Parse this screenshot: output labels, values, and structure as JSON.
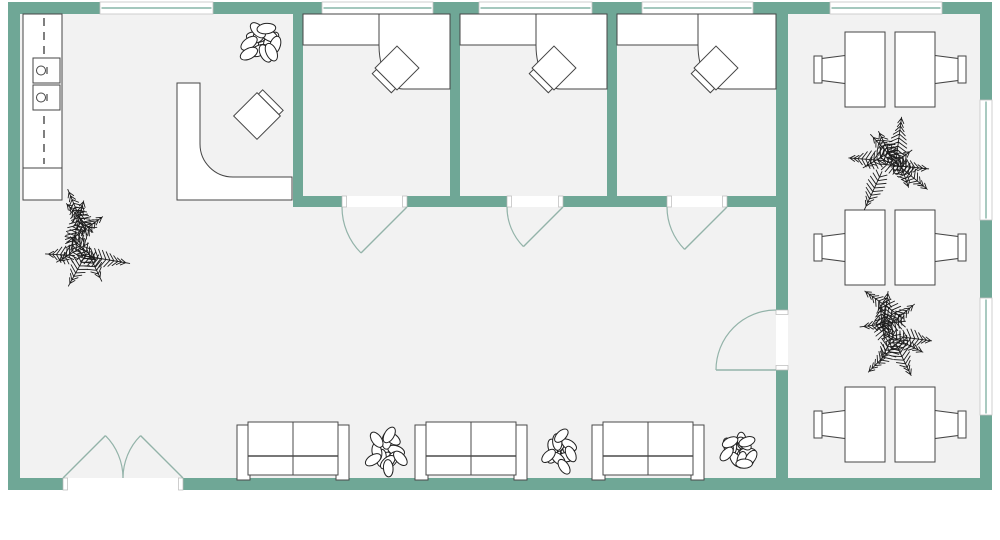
{
  "canvas": {
    "width": 1000,
    "height": 540
  },
  "colors": {
    "background": "#FFFFFF",
    "floor": "#F2F2F2",
    "wall": "#6FA796",
    "window_glass": "#FFFFFF",
    "window_frame": "#C4C4C4",
    "window_mullion": "#6FA796",
    "door": "#93B3A9",
    "jamb": "#B9B9B9",
    "furniture_stroke": "#454545",
    "furniture_fill": "#FFFFFF",
    "sofa_stroke": "#4A4A4A",
    "plant_leaf_stroke": "#222222",
    "plant_palm": "#1C1C1C"
  },
  "building": {
    "x": 8,
    "y": 2,
    "w": 984,
    "h": 488,
    "wall_thickness": 12
  },
  "exterior_walls": [
    {
      "name": "exterior-wall-top",
      "x": 8,
      "y": 2,
      "w": 984,
      "h": 12
    },
    {
      "name": "exterior-wall-bottom",
      "x": 8,
      "y": 478,
      "w": 984,
      "h": 12
    },
    {
      "name": "exterior-wall-left",
      "x": 8,
      "y": 2,
      "w": 12,
      "h": 488
    },
    {
      "name": "exterior-wall-right",
      "x": 980,
      "y": 2,
      "w": 12,
      "h": 488
    }
  ],
  "interior_walls": [
    {
      "name": "office-wall-left",
      "x": 293,
      "y": 14,
      "w": 10,
      "h": 193
    },
    {
      "name": "office-wall-1-2",
      "x": 450,
      "y": 14,
      "w": 10,
      "h": 193
    },
    {
      "name": "office-wall-2-3",
      "x": 607,
      "y": 14,
      "w": 10,
      "h": 193
    },
    {
      "name": "cafe-divider-wall",
      "x": 776,
      "y": 14,
      "w": 12,
      "h": 464
    },
    {
      "name": "office-front-wall",
      "x": 293,
      "y": 196,
      "w": 495,
      "h": 11
    }
  ],
  "windows": [
    {
      "name": "window-top-1",
      "x": 100,
      "y": 2,
      "w": 113,
      "h": 12,
      "orient": "h"
    },
    {
      "name": "window-top-2",
      "x": 322,
      "y": 2,
      "w": 111,
      "h": 12,
      "orient": "h"
    },
    {
      "name": "window-top-3",
      "x": 479,
      "y": 2,
      "w": 113,
      "h": 12,
      "orient": "h"
    },
    {
      "name": "window-top-4",
      "x": 642,
      "y": 2,
      "w": 111,
      "h": 12,
      "orient": "h"
    },
    {
      "name": "window-top-5",
      "x": 830,
      "y": 2,
      "w": 112,
      "h": 12,
      "orient": "h"
    },
    {
      "name": "window-right-1",
      "x": 980,
      "y": 100,
      "w": 12,
      "h": 120,
      "orient": "v"
    },
    {
      "name": "window-right-2",
      "x": 980,
      "y": 298,
      "w": 12,
      "h": 117,
      "orient": "v"
    }
  ],
  "door_openings": [
    {
      "name": "entry-opening",
      "x": 63,
      "y": 478,
      "w": 120,
      "h": 12
    },
    {
      "name": "office-door-opening-1",
      "x": 342,
      "y": 196,
      "w": 65,
      "h": 11
    },
    {
      "name": "office-door-opening-2",
      "x": 507,
      "y": 196,
      "w": 56,
      "h": 11
    },
    {
      "name": "office-door-opening-3",
      "x": 667,
      "y": 196,
      "w": 60,
      "h": 11
    },
    {
      "name": "cafe-door-opening",
      "x": 776,
      "y": 310,
      "w": 12,
      "h": 60
    }
  ],
  "doors": [
    {
      "name": "office-door-1",
      "hinge": [
        407,
        207
      ],
      "tip": [
        361,
        253
      ],
      "arc_from": [
        342,
        207
      ],
      "arc_to": [
        361,
        253
      ],
      "r": 65,
      "sweep": 0
    },
    {
      "name": "office-door-2",
      "hinge": [
        563,
        207
      ],
      "tip": [
        523.4,
        246.6
      ],
      "arc_from": [
        507,
        207
      ],
      "arc_to": [
        523.4,
        246.6
      ],
      "r": 56,
      "sweep": 0
    },
    {
      "name": "office-door-3",
      "hinge": [
        727,
        207
      ],
      "tip": [
        684.6,
        249.4
      ],
      "arc_from": [
        667,
        207
      ],
      "arc_to": [
        684.6,
        249.4
      ],
      "r": 60,
      "sweep": 0
    },
    {
      "name": "cafe-door",
      "hinge": [
        776,
        370
      ],
      "tip": [
        716,
        370
      ],
      "arc_from": [
        776,
        310
      ],
      "arc_to": [
        716,
        370
      ],
      "r": 60,
      "sweep": 0
    },
    {
      "name": "entry-door-left",
      "hinge": [
        63,
        478
      ],
      "tip": [
        105.4,
        435.6
      ],
      "arc_from": [
        105.4,
        435.6
      ],
      "arc_to": [
        123,
        478
      ],
      "r": 60,
      "sweep": 1
    },
    {
      "name": "entry-door-right",
      "hinge": [
        183,
        478
      ],
      "tip": [
        140.6,
        435.6
      ],
      "arc_from": [
        140.6,
        435.6
      ],
      "arc_to": [
        123,
        478
      ],
      "r": 60,
      "sweep": 0
    }
  ],
  "furniture": {
    "kitchen_counter": {
      "x": 23,
      "y": 14,
      "w": 39,
      "main_h": 154,
      "cabinet_h": 32,
      "dash_x": 44,
      "appliances": [
        {
          "x": 33,
          "y": 58,
          "w": 27,
          "h": 25,
          "knob_cx": 41,
          "knob_cy": 70.5,
          "tick_x": 47
        },
        {
          "x": 33,
          "y": 85,
          "w": 27,
          "h": 25,
          "knob_cx": 41,
          "knob_cy": 97.5,
          "tick_x": 47
        }
      ]
    },
    "reception_desk": {
      "outline": "M177,83 L177,200 L292,200 L292,177 L233,177 A33,33 0 0 1 200,144 L200,83 Z"
    },
    "reception_chair": {
      "cx": 257,
      "cy": 116,
      "size": 33,
      "rotate": -45,
      "back_side": "right"
    },
    "office_desks": [
      {
        "name": "office-desk-1",
        "left": 303,
        "right": 450,
        "divider": 379
      },
      {
        "name": "office-desk-2",
        "left": 460,
        "right": 607,
        "divider": 536
      },
      {
        "name": "office-desk-3",
        "left": 617,
        "right": 776,
        "divider": 698
      }
    ],
    "office_chair_spec": {
      "size": 31,
      "rotate": -45,
      "back_side": "left"
    },
    "office_chairs": [
      {
        "name": "office-chair-1",
        "cx": 397,
        "cy": 68
      },
      {
        "name": "office-chair-2",
        "cx": 554,
        "cy": 68
      },
      {
        "name": "office-chair-3",
        "cx": 716,
        "cy": 68
      }
    ],
    "sofa_spec": {
      "y": 422,
      "w": 112,
      "h": 56
    },
    "sofas": [
      {
        "name": "sofa-1",
        "x": 237
      },
      {
        "name": "sofa-2",
        "x": 415
      },
      {
        "name": "sofa-3",
        "x": 592
      }
    ],
    "dining_spec": {
      "table_x": [
        845,
        895
      ],
      "table_w": 40,
      "table_h": 75,
      "chair_back_w": 8
    },
    "dining_sets": [
      {
        "name": "dining-set-1",
        "top": 32
      },
      {
        "name": "dining-set-2",
        "top": 210
      },
      {
        "name": "dining-set-3",
        "top": 387
      }
    ]
  },
  "plants": [
    {
      "name": "leafy-plant-reception",
      "kind": "leafy",
      "cx": 262,
      "cy": 42,
      "r": 26,
      "seed": 3
    },
    {
      "name": "palm-plant-lobby",
      "kind": "palm",
      "cx": 80,
      "cy": 242,
      "r": 52,
      "seed": 5
    },
    {
      "name": "leafy-plant-sofa-1",
      "kind": "leafy",
      "cx": 386,
      "cy": 451,
      "r": 24,
      "seed": 8
    },
    {
      "name": "leafy-plant-sofa-2",
      "kind": "leafy",
      "cx": 562,
      "cy": 451,
      "r": 23,
      "seed": 12
    },
    {
      "name": "leafy-plant-sofa-3",
      "kind": "leafy",
      "cx": 740,
      "cy": 451,
      "r": 23,
      "seed": 17
    },
    {
      "name": "palm-plant-cafe-1",
      "kind": "palm",
      "cx": 890,
      "cy": 160,
      "r": 48,
      "seed": 21
    },
    {
      "name": "palm-plant-cafe-2",
      "kind": "palm",
      "cx": 892,
      "cy": 332,
      "r": 50,
      "seed": 27
    }
  ]
}
